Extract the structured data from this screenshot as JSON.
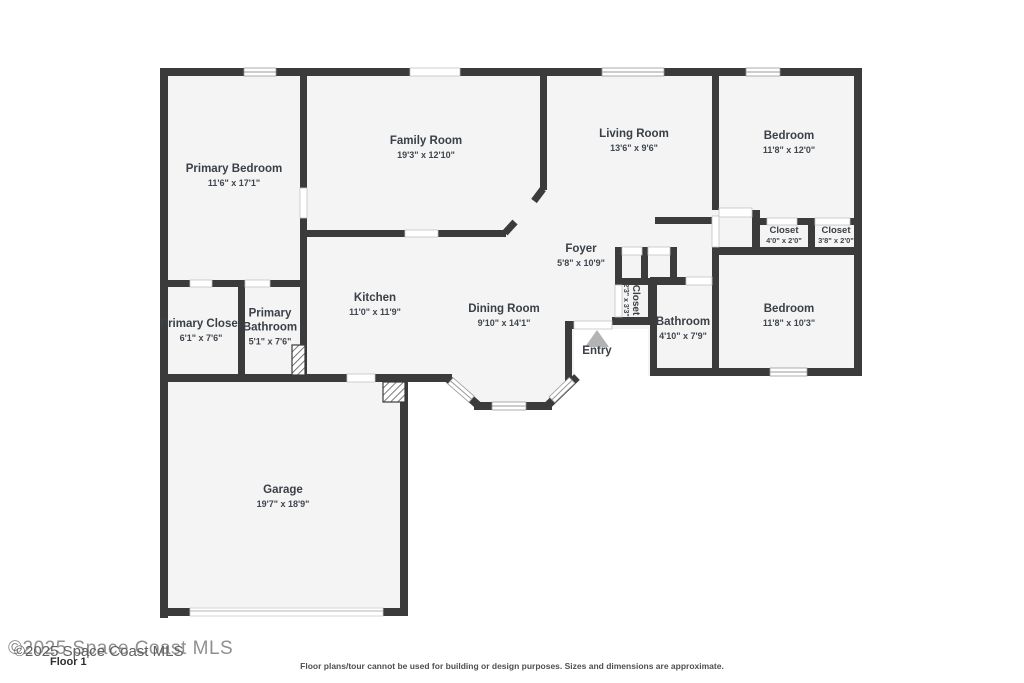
{
  "colors": {
    "wall": "#3b3b3b",
    "room_fill": "#f4f4f4",
    "entry_arrow": "#b3b3b3"
  },
  "rooms": {
    "primary_bedroom": {
      "name": "Primary Bedroom",
      "dims": "11'6\" x 17'1\""
    },
    "family_room": {
      "name": "Family Room",
      "dims": "19'3\" x 12'10\""
    },
    "living_room": {
      "name": "Living Room",
      "dims": "13'6\" x 9'6\""
    },
    "bedroom_top": {
      "name": "Bedroom",
      "dims": "11'8\" x 12'0\""
    },
    "closet_a": {
      "name": "Closet",
      "dims": "4'0\" x 2'0\""
    },
    "closet_b": {
      "name": "Closet",
      "dims": "3'8\" x 2'0\""
    },
    "foyer": {
      "name": "Foyer",
      "dims": "5'8\" x 10'9\""
    },
    "kitchen": {
      "name": "Kitchen",
      "dims": "11'0\" x 11'9\""
    },
    "dining_room": {
      "name": "Dining Room",
      "dims": "9'10\" x 14'1\""
    },
    "primary_closet": {
      "name": "Primary Closet",
      "dims": "6'1\" x 7'6\""
    },
    "primary_bathroom": {
      "name": "Primary Bathroom",
      "dims": "5'1\" x 7'6\""
    },
    "hall_closet": {
      "name": "Closet",
      "dims": "2'3\" x 3'3\""
    },
    "bathroom": {
      "name": "Bathroom",
      "dims": "4'10\" x 7'9\""
    },
    "bedroom_right": {
      "name": "Bedroom",
      "dims": "11'8\" x 10'3\""
    },
    "garage": {
      "name": "Garage",
      "dims": "19'7\" x 18'9\""
    }
  },
  "entry": {
    "label": "Entry"
  },
  "footer": {
    "watermark": "©2025 Space Coast MLS",
    "floor_label": "Floor 1",
    "disclaimer": "Floor plans/tour cannot be used for building or design purposes. Sizes and dimensions are approximate."
  }
}
